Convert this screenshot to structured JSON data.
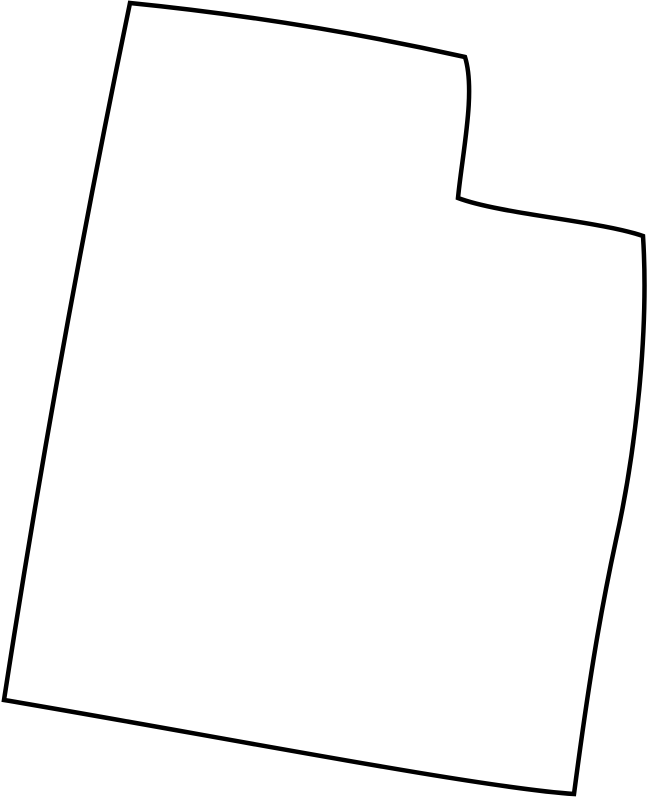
{
  "map": {
    "name": "Utah state outline",
    "region": "utah",
    "background_color": "#ffffff",
    "stroke_color": "#000000",
    "stroke_width": "4.5",
    "viewbox": "0 0 649 800",
    "path": "M 130,3 Q 300,20 465,57 C 476,92 462,155 458,198 C 500,214 600,221 643,236 C 649,330 636,450 616,540 C 602,605 590,672 574,794 C 480,788 200,733 4,700 Q 58,350 130,3 Z"
  }
}
